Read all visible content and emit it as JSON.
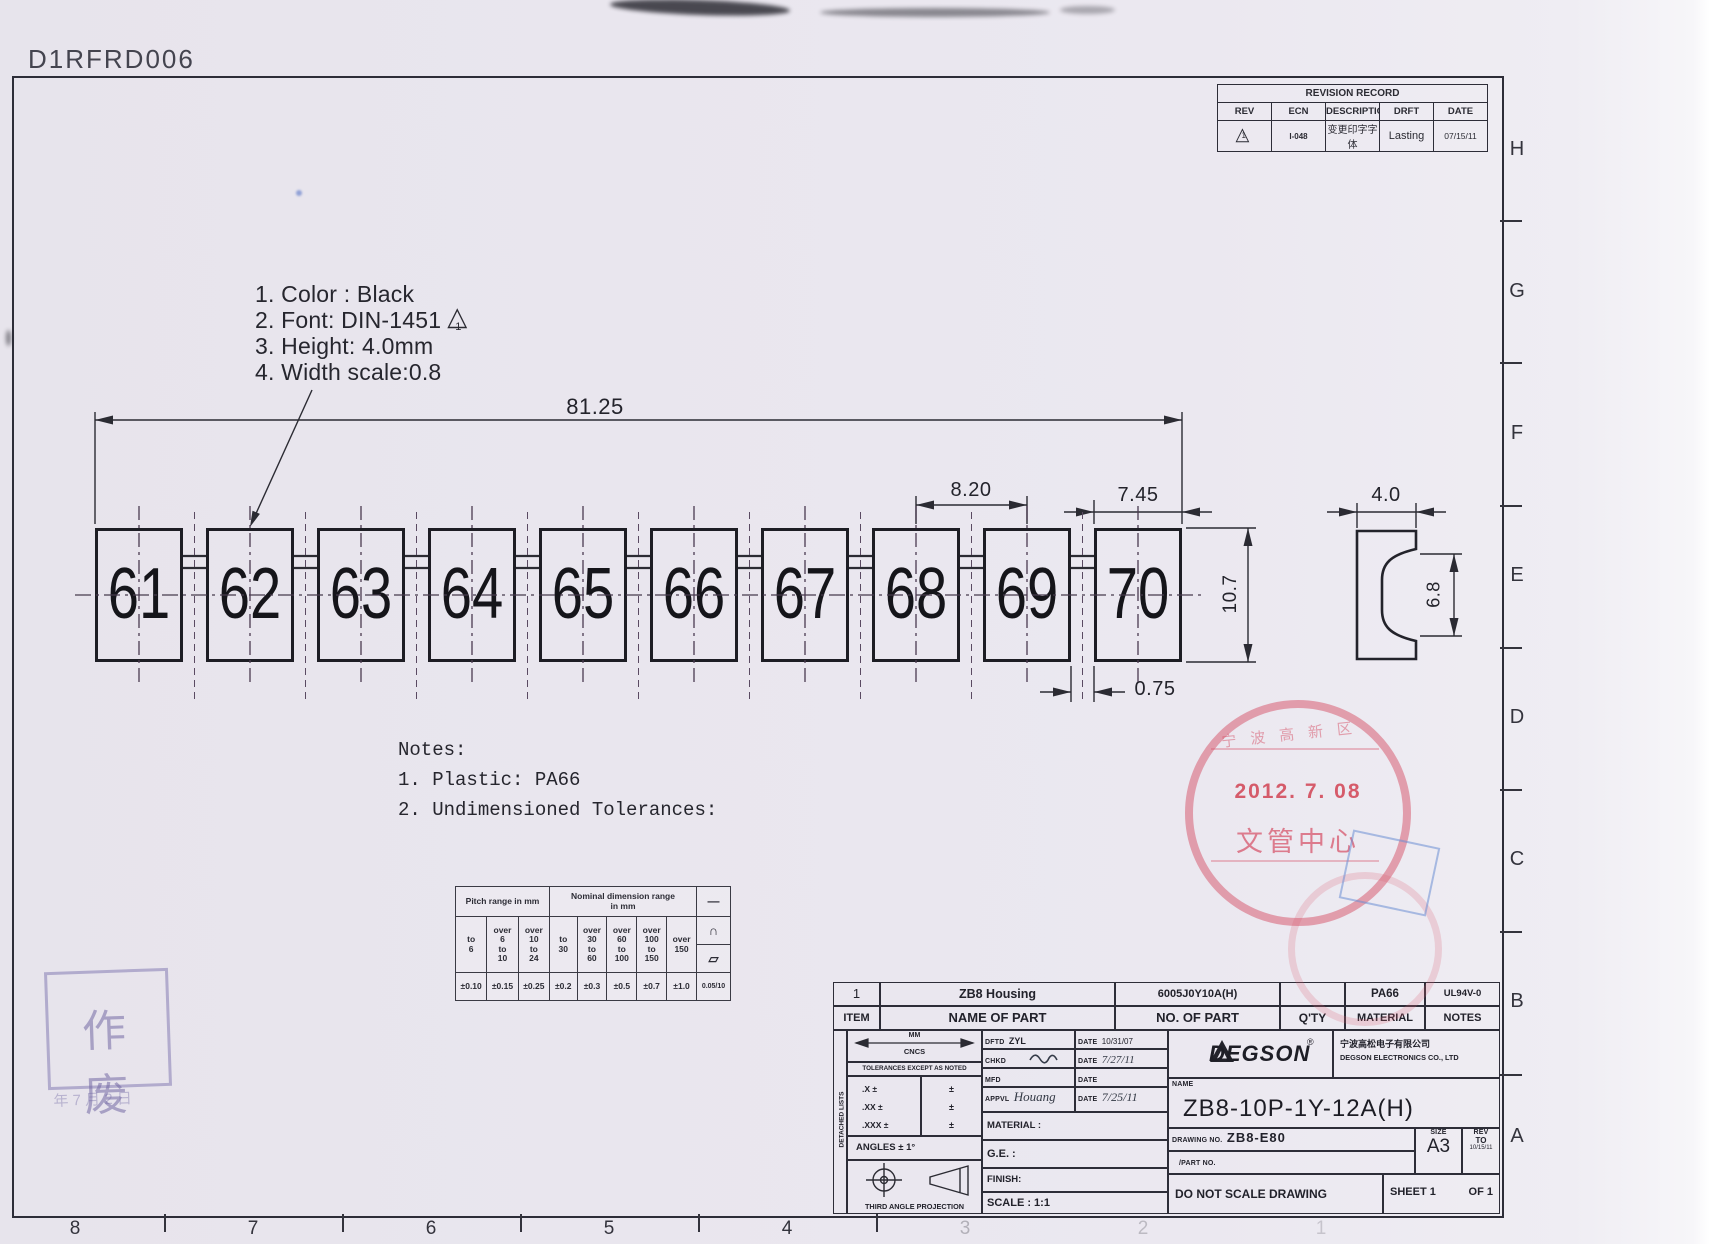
{
  "doc_code": "D1RFRD006",
  "revision_record": {
    "title": "REVISION RECORD",
    "col_rev": "REV",
    "col_ecn": "ECN",
    "col_description": "DESCRIPTION",
    "col_drft": "DRFT",
    "col_date": "DATE",
    "row": {
      "rev": "1",
      "ecn": "I-048",
      "description": "变更印字字体",
      "drft": "Lasting",
      "date": "07/15/11"
    }
  },
  "print_notes": {
    "line1": "1. Color : Black",
    "line2": "2. Font: DIN-1451",
    "flag": "1",
    "line3": "3. Height: 4.0mm",
    "line4": "4. Width scale:0.8"
  },
  "markers": {
    "labels": [
      "61",
      "62",
      "63",
      "64",
      "65",
      "66",
      "67",
      "68",
      "69",
      "70"
    ]
  },
  "dims": {
    "overall": "81.25",
    "pitch": "8.20",
    "marker_width": "7.45",
    "height": "10.7",
    "gap": "0.75",
    "profile_width": "4.0",
    "profile_height": "6.8"
  },
  "notes": {
    "title": "Notes:",
    "item1": "1. Plastic: PA66",
    "item2": "2. Undimensioned Tolerances:"
  },
  "tol_table": {
    "pitch_header": "Pitch range in mm",
    "nominal_header": "Nominal dimension range\nin mm",
    "p1": "to\n6",
    "p2": "over\n6\nto\n10",
    "p3": "over\n10\nto\n24",
    "n1": "to\n30",
    "n2": "over\n30\nto\n60",
    "n3": "over\n60\nto\n100",
    "n4": "over\n100\nto\n150",
    "n5": "over\n150",
    "v1": "±0.10",
    "v2": "±0.15",
    "v3": "±0.25",
    "v4": "±0.2",
    "v5": "±0.3",
    "v6": "±0.5",
    "v7": "±0.7",
    "v8": "±1.0",
    "sym1": "—",
    "sym2": "∩",
    "sym3": "▱",
    "sym_value": "0.05/10"
  },
  "stamps": {
    "red": {
      "arc": "宁波高新区",
      "date": "2012. 7. 08",
      "bottom": "文管中心"
    },
    "purple": {
      "text": "作 废",
      "date": "年 7 月 2 日"
    }
  },
  "title_block": {
    "parts_row": {
      "item": "1",
      "name": "ZB8  Housing",
      "no": "6005J0Y10A(H)",
      "qty": "",
      "material": "PA66",
      "notes": "UL94V-0"
    },
    "header": {
      "item": "ITEM",
      "name": "NAME OF PART",
      "no": "NO. OF  PART",
      "qty": "Q'TY",
      "material": "MATERIAL",
      "notes": "NOTES"
    },
    "detached": "DETACHED LISTS",
    "mm": "MM",
    "cncs": "CNCS",
    "tol_note": "TOLERANCES EXCEPT AS NOTED",
    "tol_x": ".X ±",
    "tol_xx": ".XX ±",
    "tol_xxx": ".XXX ±",
    "pm": "±",
    "angles": "ANGLES ± 1°",
    "projection": "THIRD ANGLE PROJECTION",
    "dftd_label": "DFTD",
    "dftd": "ZYL",
    "dftd_date_label": "DATE",
    "dftd_date": "10/31/07",
    "chkd_label": "CHKD",
    "chkd_date_label": "DATE",
    "chkd_date": "7/27/11",
    "mfd_label": "MFD",
    "mfd_date_label": "DATE",
    "appvl_label": "APPVL",
    "appvl": "Houang",
    "appvl_date_label": "DATE",
    "appvl_date": "7/25/11",
    "material_label": "MATERIAL :",
    "ge_label": "G.E. :",
    "finish_label": "FINISH:",
    "scale_label": "SCALE : 1:1",
    "brand": "DEGSON",
    "brand_reg": "®",
    "company_cn": "宁波高松电子有限公司",
    "company_en": "DEGSON ELECTRONICS CO., LTD",
    "name_label": "NAME",
    "part_name": "ZB8-10P-1Y-12A(H)",
    "drawing_no_label": "DRAWING NO.",
    "drawing_no": "ZB8-E80",
    "part_no_label": "/PART  NO.",
    "size_label": "SIZE",
    "size": "A3",
    "rev_label": "REV",
    "rev_to": "TO",
    "rev_date": "10/15/11",
    "do_not_scale": "DO NOT SCALE DRAWING",
    "sheet": "SHEET 1",
    "of": "OF 1"
  },
  "border": {
    "letters": [
      "H",
      "G",
      "F",
      "E",
      "D",
      "C",
      "B",
      "A"
    ],
    "numbers": [
      "8",
      "7",
      "6",
      "5",
      "4",
      "3",
      "2",
      "1"
    ]
  }
}
